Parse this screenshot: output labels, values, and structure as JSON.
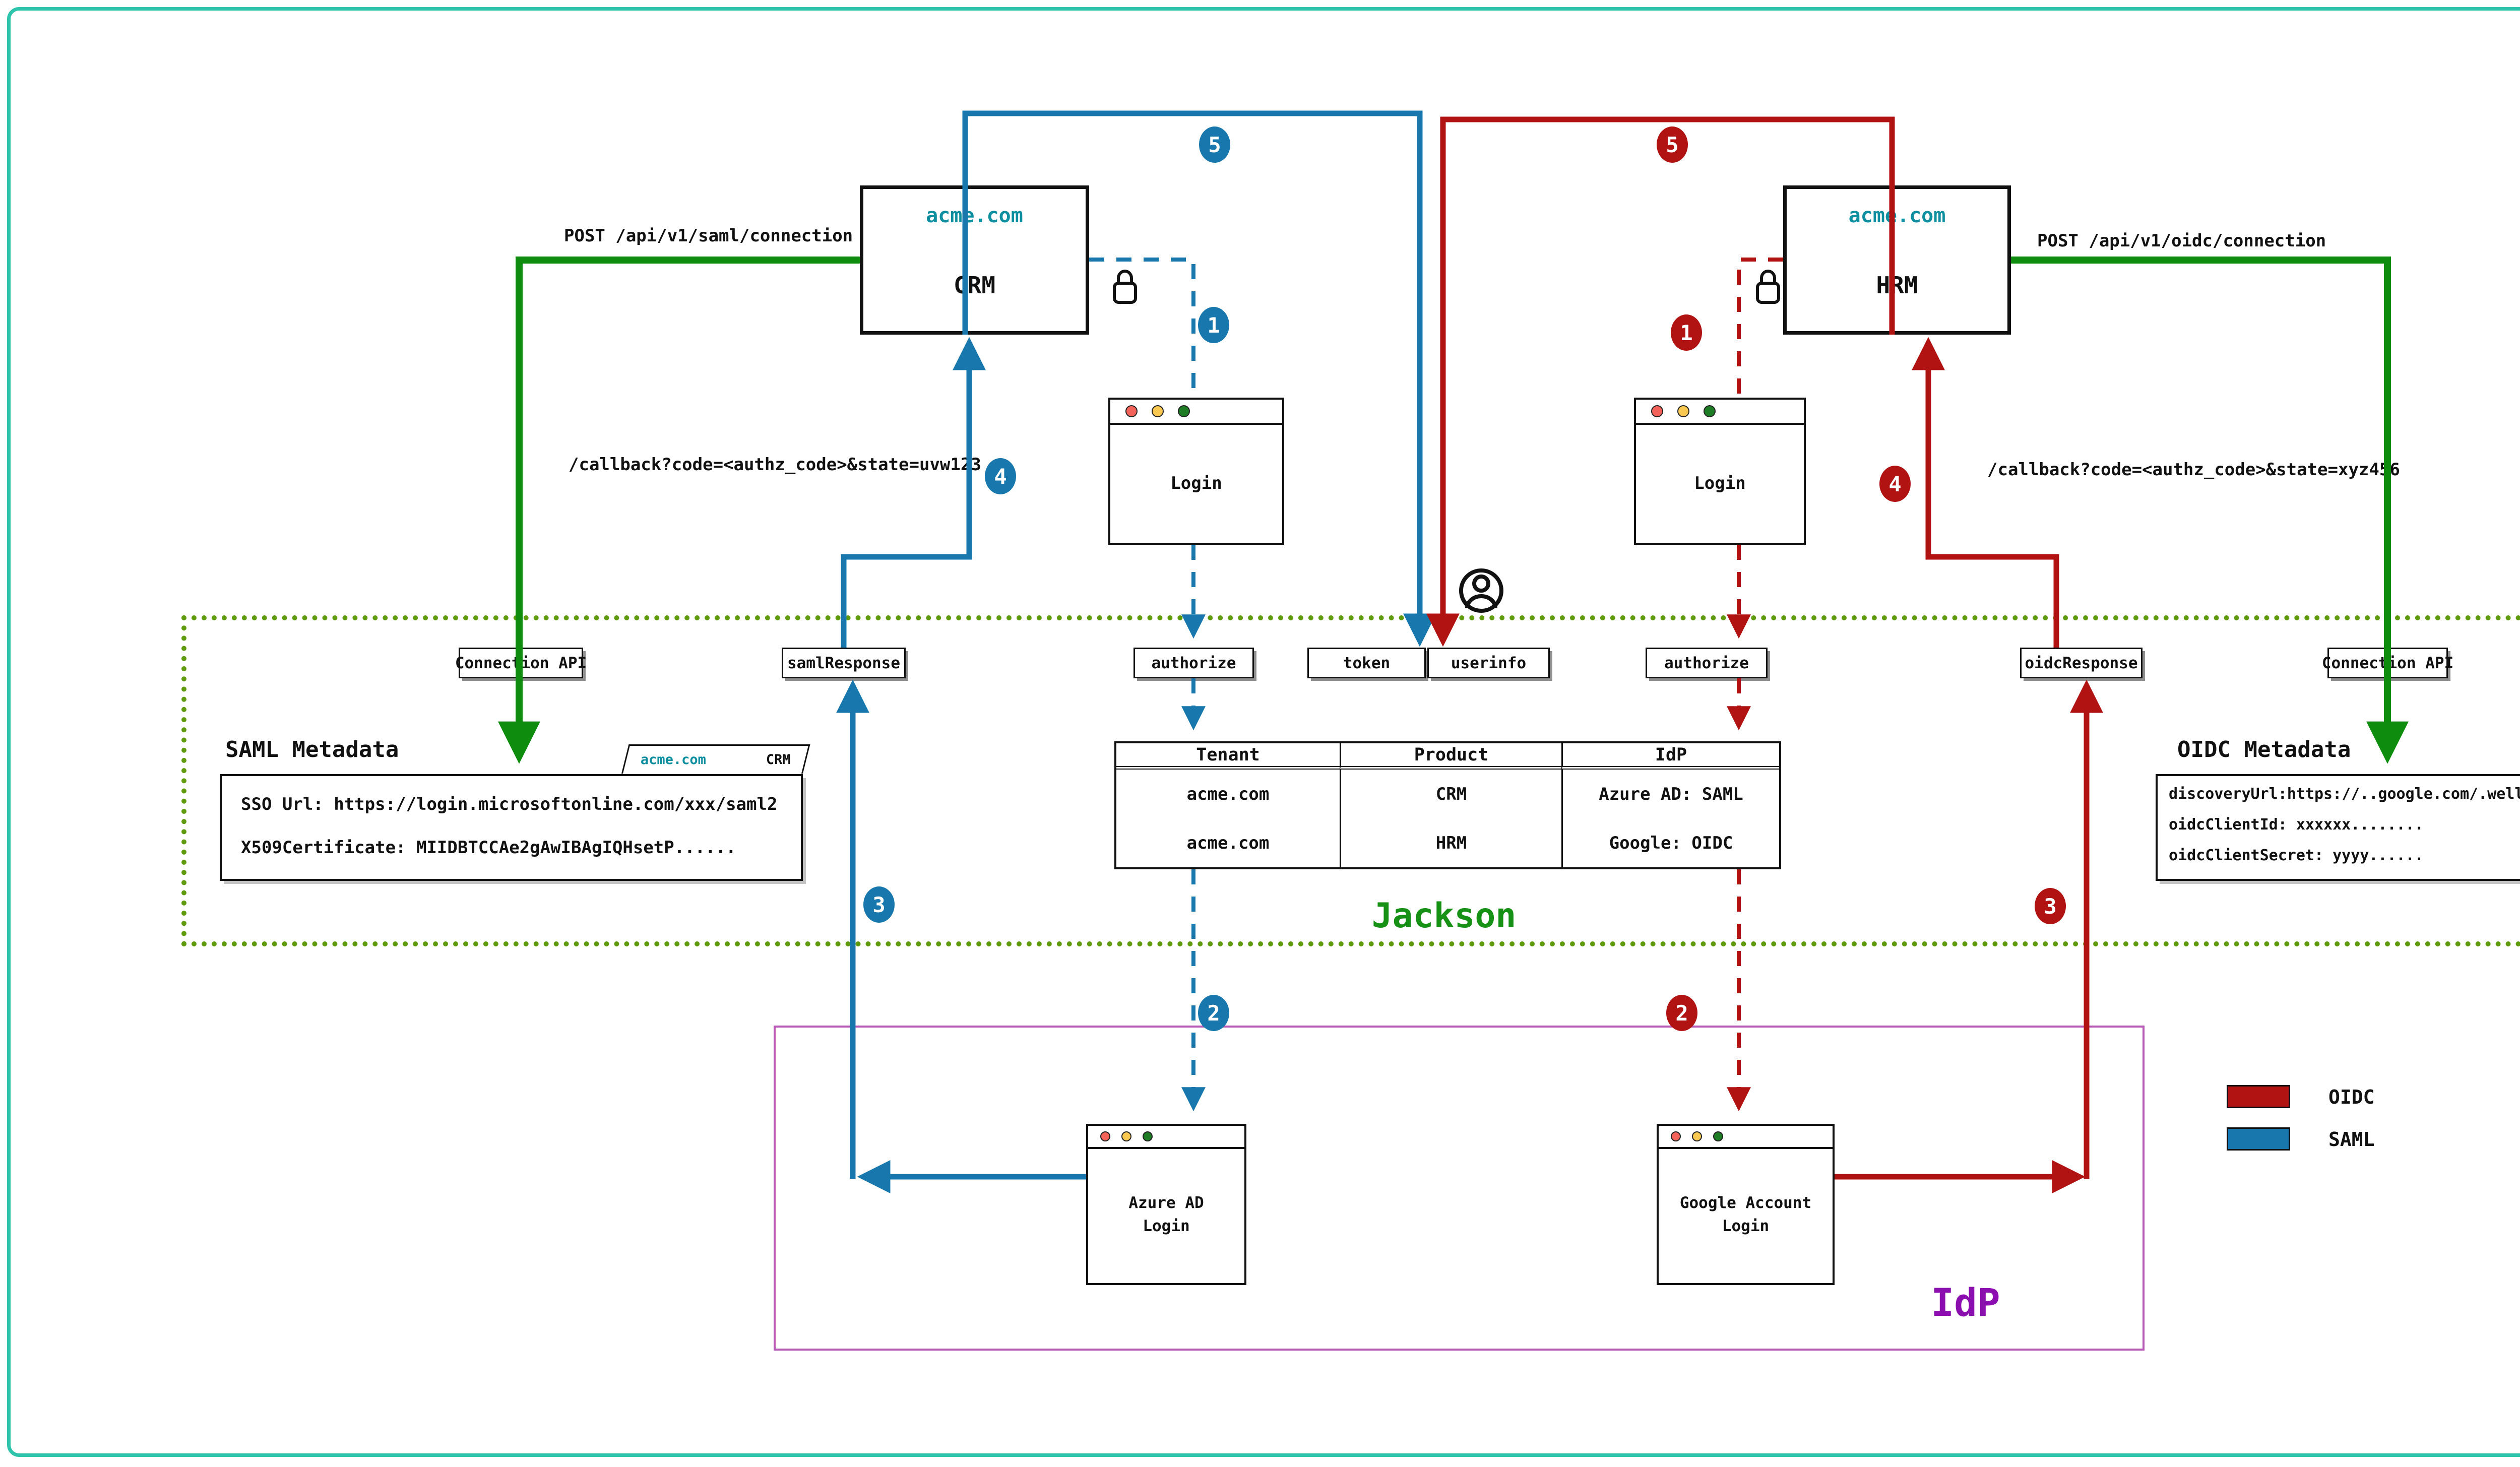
{
  "colors": {
    "saml_blue": "#1878ad",
    "oidc_red": "#b11212",
    "connection_green": "#0d8c0d",
    "jackson_border_olive": "#5f9b0d",
    "jackson_text_green": "#169116",
    "idp_border_purple": "#b65ab6",
    "idp_text_purple": "#8a0fae",
    "domain_teal": "#0e8fa0",
    "frame_teal": "#2ec4ab"
  },
  "apps": {
    "crm": {
      "domain": "acme.com",
      "name": "CRM"
    },
    "hrm": {
      "domain": "acme.com",
      "name": "HRM"
    }
  },
  "flows": {
    "saml_post": "POST /api/v1/saml/connection",
    "oidc_post": "POST /api/v1/oidc/connection",
    "saml_callback": "/callback?code=<authz_code>&state=uvw123",
    "oidc_callback": "/callback?code=<authz_code>&state=xyz456"
  },
  "steps": {
    "one": "1",
    "two": "2",
    "three": "3",
    "four": "4",
    "five": "5"
  },
  "browser": {
    "login": "Login"
  },
  "jackson": {
    "label": "Jackson",
    "endpoints": {
      "connection_api_left": "Connection API",
      "saml_response": "samlResponse",
      "authorize_saml": "authorize",
      "token": "token",
      "userinfo": "userinfo",
      "authorize_oidc": "authorize",
      "oidc_response": "oidcResponse",
      "connection_api_right": "Connection API"
    },
    "saml_metadata": {
      "title": "SAML Metadata",
      "tab_domain": "acme.com",
      "tab_product": "CRM",
      "line1": "SSO Url: https://login.microsoftonline.com/xxx/saml2",
      "line2": "X509Certificate: MIIDBTCCAe2gAwIBAgIQHsetP......"
    },
    "oidc_metadata": {
      "title": "OIDC Metadata",
      "tab_domain": "acme.com",
      "tab_product": "HRM",
      "line1": "discoveryUrl:https://..google.com/.well-known/openid-configuration",
      "line2": "oidcClientId: xxxxxx........",
      "line3": "oidcClientSecret: yyyy......"
    },
    "table": {
      "headers": [
        "Tenant",
        "Product",
        "IdP"
      ],
      "rows": [
        [
          "acme.com",
          "CRM",
          "Azure AD: SAML"
        ],
        [
          "acme.com",
          "HRM",
          "Google: OIDC"
        ]
      ]
    }
  },
  "idp": {
    "label": "IdP",
    "azure_line1": "Azure AD",
    "azure_line2": "Login",
    "google_line1": "Google Account",
    "google_line2": "Login"
  },
  "legend": {
    "items": [
      {
        "label": "OIDC",
        "color": "#b11212"
      },
      {
        "label": "SAML",
        "color": "#1878ad"
      }
    ]
  }
}
